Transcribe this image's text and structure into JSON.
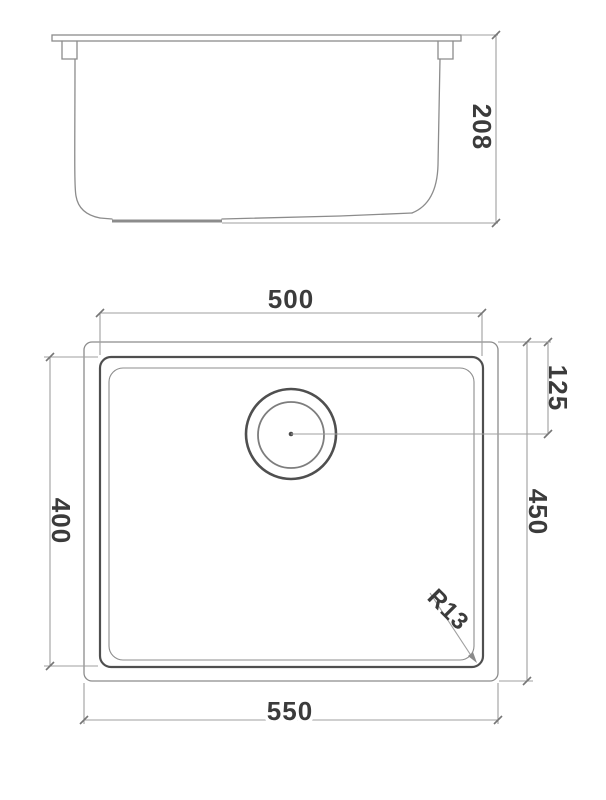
{
  "colors": {
    "background": "#ffffff",
    "outline": "#8c8c8c",
    "outline_dark": "#4f4f4f",
    "dimension_line": "#9f9f9f",
    "label_text": "#3b3b3b"
  },
  "side_view": {
    "dimensions": {
      "height": {
        "label": "208"
      }
    }
  },
  "plan_view": {
    "dimensions": {
      "inner_width": {
        "label": "500"
      },
      "drain_offset": {
        "label": "125"
      },
      "inner_depth": {
        "label": "400"
      },
      "overall_depth": {
        "label": "450"
      },
      "overall_width": {
        "label": "550"
      },
      "corner_radius": {
        "label": "R13"
      }
    }
  }
}
